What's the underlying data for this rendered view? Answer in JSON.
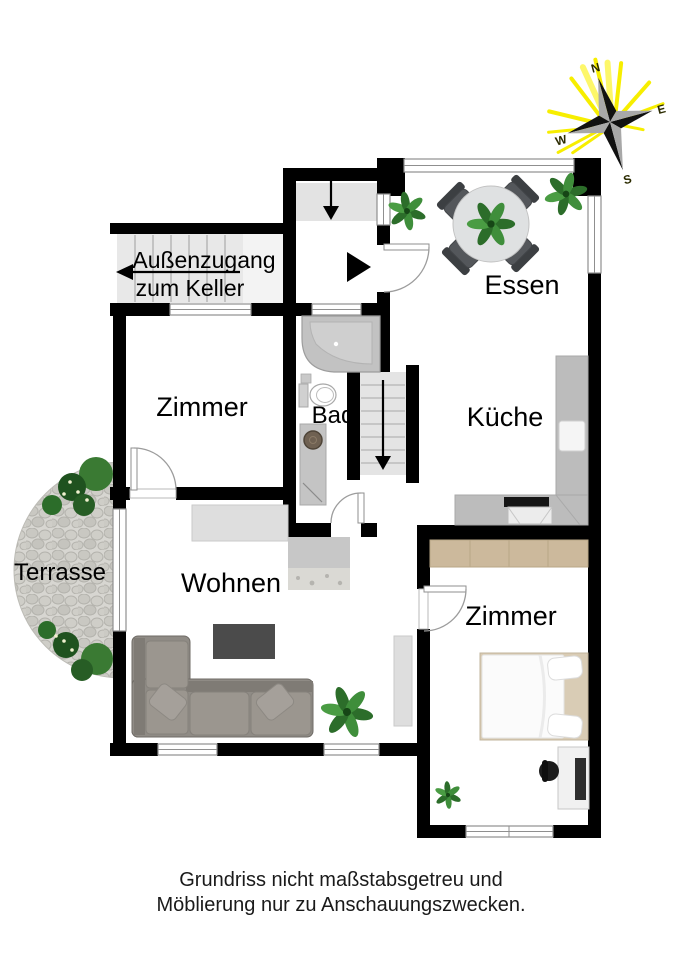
{
  "plan": {
    "rooms": {
      "essen": "Essen",
      "kueche": "Küche",
      "bad": "Bad",
      "zimmer_top": "Zimmer",
      "zimmer_bottom": "Zimmer",
      "wohnen": "Wohnen",
      "terrasse": "Terrasse"
    },
    "annotations": {
      "basement_access_line1": "Außenzugang",
      "basement_access_line2": "zum Keller"
    },
    "compass": {
      "north": "N",
      "east": "E",
      "south": "S",
      "west": "W"
    },
    "disclaimer": {
      "line1": "Grundriss nicht maßstabsgetreu und",
      "line2": "Möblierung nur zu Anschauungszwecken."
    },
    "colors": {
      "wall": "#000000",
      "window_frame": "#8f8f8f",
      "stairs": "#e8e8e8",
      "entry_strip": "#e3e3e3",
      "sofa": "#8f8b85",
      "rug": "#4b4b4b",
      "counter": "#bcbcbc",
      "wardrobe": "#ccb99c",
      "bed_frame": "#d9ccb5",
      "terrace_stone": "#d7d6d1",
      "plant": "#2f7a2f",
      "compass_ray": "#f7ee00",
      "star_dark": "#111111",
      "star_light": "#a8a8a8"
    }
  }
}
